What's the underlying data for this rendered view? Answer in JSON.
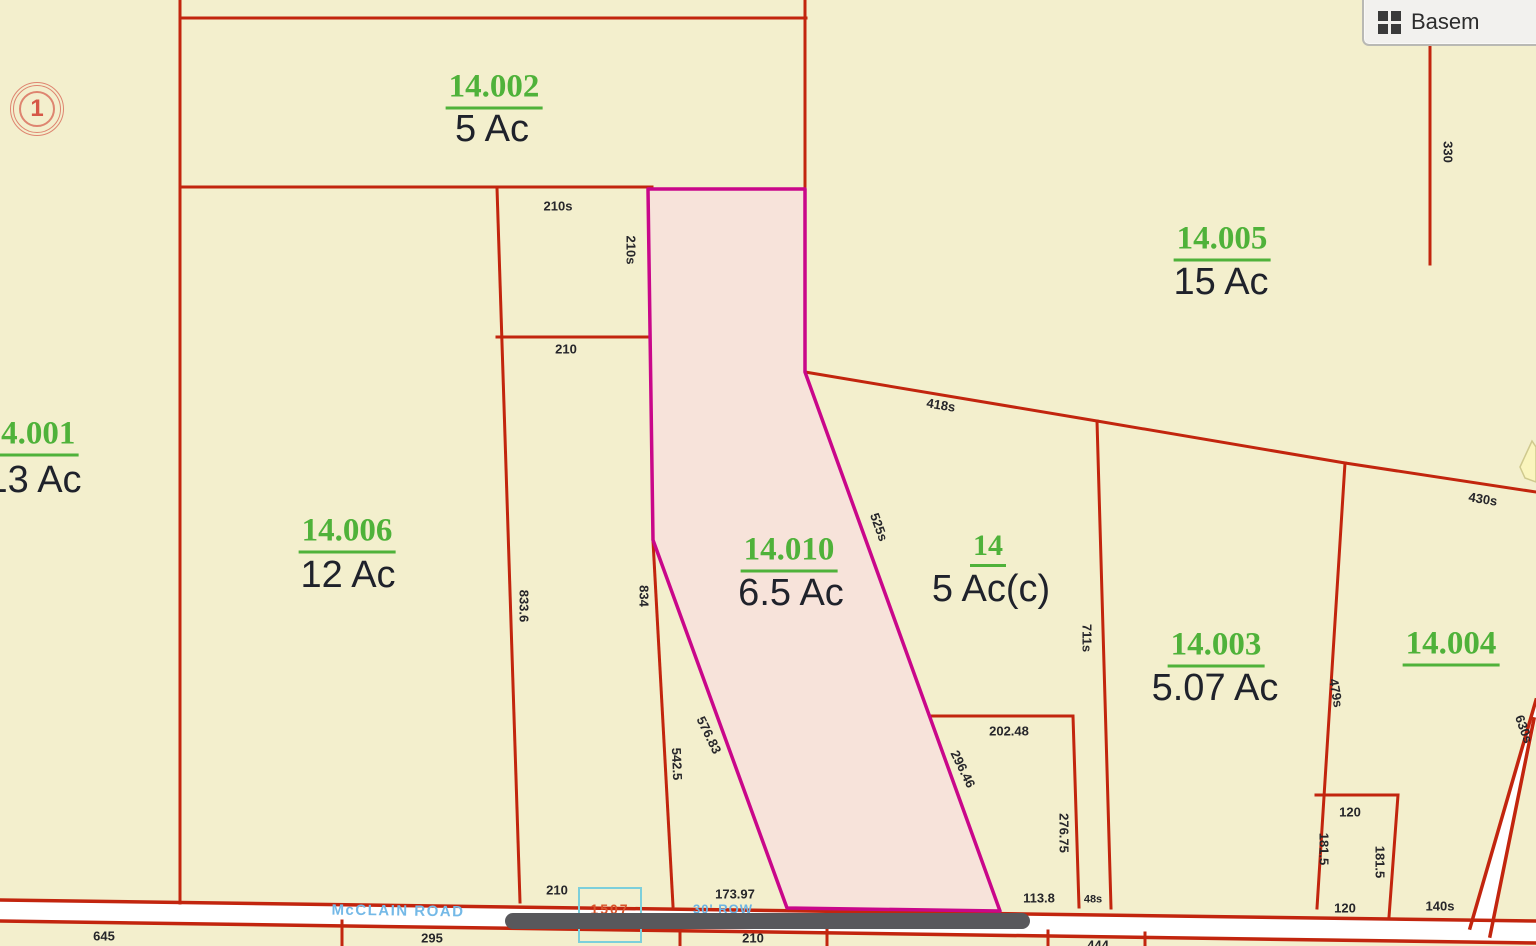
{
  "toolbar": {
    "basemap_label": "Basem"
  },
  "section_marker": {
    "number": "1"
  },
  "parcels": [
    {
      "id": "14.002",
      "acreage": "5 Ac"
    },
    {
      "id": "14.005",
      "acreage": "15 Ac"
    },
    {
      "id": "14.001",
      "acreage": "13 Ac"
    },
    {
      "id": "14.006",
      "acreage": "12 Ac"
    },
    {
      "id": "14.010",
      "acreage": "6.5 Ac",
      "highlighted": true
    },
    {
      "id": "14",
      "acreage": "5 Ac(c)"
    },
    {
      "id": "14.003",
      "acreage": "5.07 Ac"
    },
    {
      "id": "14.004",
      "acreage": ""
    }
  ],
  "roads": {
    "mcclain": "McCLAIN ROAD",
    "row": "30' ROW",
    "road_box_number": "1507"
  },
  "dimensions": {
    "top_210s": "210s",
    "side_210s": "210s",
    "mid_210": "210",
    "left_833_6": "833.6",
    "right_834": "834",
    "d542_5": "542.5",
    "d576_83": "576.83",
    "d525s": "525s",
    "d418s": "418s",
    "d430s": "430s",
    "d330": "330",
    "d711s": "711s",
    "d479s": "479s",
    "d202_48": "202.48",
    "d296_46": "296.46",
    "d276_75": "276.75",
    "d120_top": "120",
    "d181_5_left": "181.5",
    "d181_5_right": "181.5",
    "d120_bottom": "120",
    "d140s": "140s",
    "d630s": "630s",
    "road_210": "210",
    "d173_97": "173.97",
    "d113_8": "113.8",
    "d48s": "48s",
    "d645": "645",
    "d295": "295",
    "below_210": "210",
    "d444": "444"
  },
  "colors": {
    "background": "#f3efcd",
    "parcel_line_red": "#c2250e",
    "highlight_border_magenta": "#c9078a",
    "highlight_fill_pink": "#f7e2db",
    "parcel_number_green": "#4fb23a",
    "acreage_text": "#1f222b",
    "dimension_text": "#26262a",
    "road_fill": "#ffffff",
    "road_label_blue": "#74b9e7",
    "selection_box_cyan": "#7ccfdb",
    "box_number_red": "#d9542b",
    "scrollbar_thumb": "#58585c",
    "marker_red": "#de8570"
  }
}
